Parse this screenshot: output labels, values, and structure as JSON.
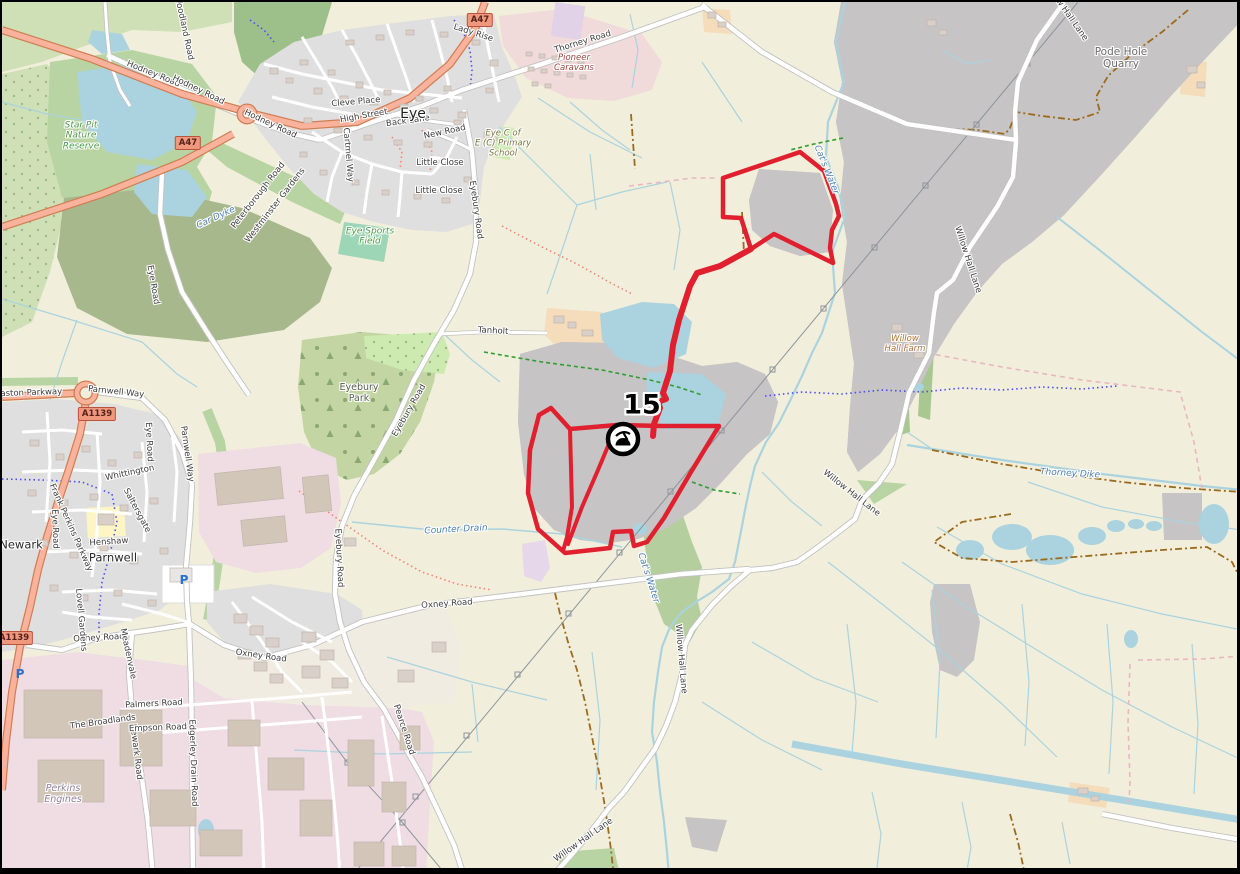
{
  "window": {
    "type": "map-viewer",
    "style": "openstreetmap-carto"
  },
  "map": {
    "marker": {
      "label": "15",
      "icon": "mine-pit-icon"
    },
    "colors": {
      "boundary_red": "#e0202e",
      "water": "#aad3df",
      "quarry": "#c6c4c4",
      "residential": "#e0dfdf",
      "industrial": "#f0dde3",
      "farmland": "#f1efdb",
      "grass": "#b8d4a2",
      "forest": "#9dbf89",
      "farmyard": "#f5dcba",
      "trunk_road": "#f9b29c",
      "road": "#ffffff",
      "track": "#9c6a1d",
      "cycleway": "#4b4bf7",
      "footpath": "#fa8072",
      "bridleway": "#2f9e2f"
    },
    "badges": [
      {
        "t": "A47",
        "x": 186,
        "y": 141
      },
      {
        "t": "A47",
        "x": 478,
        "y": 18
      },
      {
        "t": "A1139",
        "x": 95,
        "y": 412
      },
      {
        "t": "A1139",
        "x": 12,
        "y": 636
      }
    ],
    "parking": [
      {
        "x": 182,
        "y": 578
      },
      {
        "x": 18,
        "y": 672
      }
    ],
    "labels": [
      {
        "t": "Woodland Road",
        "x": 181,
        "y": 26,
        "r": 78,
        "c": "rd"
      },
      {
        "t": "Hodney Road",
        "x": 151,
        "y": 73,
        "r": 22,
        "c": "rd"
      },
      {
        "t": "Hodney Road",
        "x": 196,
        "y": 89,
        "r": 26,
        "c": "rd"
      },
      {
        "t": "Hodney Road",
        "x": 268,
        "y": 123,
        "r": 25,
        "c": "rd"
      },
      {
        "t": "High Street",
        "x": 362,
        "y": 115,
        "r": -10,
        "c": "rd"
      },
      {
        "t": "Back Lane",
        "x": 406,
        "y": 120,
        "r": -8,
        "c": "rd"
      },
      {
        "t": "New Road",
        "x": 443,
        "y": 131,
        "r": -12,
        "c": "rd"
      },
      {
        "t": "Little Close",
        "x": 438,
        "y": 162,
        "r": 0,
        "c": "rd"
      },
      {
        "t": "Little Close",
        "x": 437,
        "y": 190,
        "r": 0,
        "c": "rd"
      },
      {
        "t": "Lady Rise",
        "x": 471,
        "y": 32,
        "r": 18,
        "c": "rd"
      },
      {
        "t": "Cleve Place",
        "x": 354,
        "y": 101,
        "r": -5,
        "c": "rd"
      },
      {
        "t": "Cartmel Way",
        "x": 345,
        "y": 153,
        "r": 85,
        "c": "rd"
      },
      {
        "t": "Peterborough Road",
        "x": 257,
        "y": 194,
        "r": -52,
        "c": "rd"
      },
      {
        "t": "Westminster Gardens",
        "x": 274,
        "y": 204,
        "r": -52,
        "c": "rd"
      },
      {
        "t": "Thorney Road",
        "x": 581,
        "y": 41,
        "r": -17,
        "c": "rd"
      },
      {
        "t": "Eyebury Road",
        "x": 473,
        "y": 208,
        "r": 82,
        "c": "rd"
      },
      {
        "t": "Eyebury Road",
        "x": 408,
        "y": 409,
        "r": -60,
        "c": "rd"
      },
      {
        "t": "Eyebury Road",
        "x": 336,
        "y": 556,
        "r": 87,
        "c": "rd"
      },
      {
        "t": "Tanholt",
        "x": 491,
        "y": 330,
        "r": 3,
        "c": "rd"
      },
      {
        "t": "Pearce Road",
        "x": 401,
        "y": 728,
        "r": 72,
        "c": "rd"
      },
      {
        "t": "Oxney Road",
        "x": 97,
        "y": 637,
        "r": -3,
        "c": "rd"
      },
      {
        "t": "Oxney Road",
        "x": 259,
        "y": 655,
        "r": 8,
        "c": "rd"
      },
      {
        "t": "Oxney Road",
        "x": 445,
        "y": 603,
        "r": -4,
        "c": "rd"
      },
      {
        "t": "Willow Hall Lane",
        "x": 1063,
        "y": 10,
        "r": 55,
        "c": "rd"
      },
      {
        "t": "Willow Hall Lane",
        "x": 965,
        "y": 258,
        "r": 72,
        "c": "rd"
      },
      {
        "t": "Willow Hall Lane",
        "x": 849,
        "y": 492,
        "r": 38,
        "c": "rd"
      },
      {
        "t": "Willow Hall Lane",
        "x": 678,
        "y": 657,
        "r": 85,
        "c": "rd"
      },
      {
        "t": "Willow Hall Lane",
        "x": 582,
        "y": 839,
        "r": -35,
        "c": "rd"
      },
      {
        "t": "Edgerley Drain Road",
        "x": 190,
        "y": 761,
        "r": 88,
        "c": "rd"
      },
      {
        "t": "Newark Road",
        "x": 133,
        "y": 750,
        "r": 83,
        "c": "rd"
      },
      {
        "t": "Palmers Road",
        "x": 152,
        "y": 703,
        "r": -3,
        "c": "rd"
      },
      {
        "t": "Empson Road",
        "x": 156,
        "y": 727,
        "r": -2,
        "c": "rd"
      },
      {
        "t": "The Broadlands",
        "x": 101,
        "y": 721,
        "r": -8,
        "c": "rd"
      },
      {
        "t": "Whittington",
        "x": 128,
        "y": 472,
        "r": -12,
        "c": "rd"
      },
      {
        "t": "Saltersgate",
        "x": 134,
        "y": 509,
        "r": 62,
        "c": "rd"
      },
      {
        "t": "Henshaw",
        "x": 107,
        "y": 541,
        "r": -4,
        "c": "rd"
      },
      {
        "t": "Lovell Gardens",
        "x": 78,
        "y": 618,
        "r": 85,
        "c": "rd"
      },
      {
        "t": "Meadenvale",
        "x": 125,
        "y": 652,
        "r": 78,
        "c": "rd"
      },
      {
        "t": "Parnwell Way",
        "x": 114,
        "y": 391,
        "r": 6,
        "c": "rd"
      },
      {
        "t": "Parnwell Way",
        "x": 184,
        "y": 452,
        "r": 82,
        "c": "rd"
      },
      {
        "t": "Paston Parkway",
        "x": 27,
        "y": 392,
        "r": -2,
        "c": "rd"
      },
      {
        "t": "Frank Perkins Parkway",
        "x": 68,
        "y": 526,
        "r": 66,
        "c": "rd"
      },
      {
        "t": "Eye Road",
        "x": 150,
        "y": 283,
        "r": 80,
        "c": "rd"
      },
      {
        "t": "Eye Road",
        "x": 146,
        "y": 440,
        "r": 87,
        "c": "rd"
      },
      {
        "t": "Eye Road",
        "x": 52,
        "y": 527,
        "r": 88,
        "c": "rd"
      },
      {
        "t": "Eye",
        "x": 411,
        "y": 112,
        "r": 0,
        "c": "pl"
      },
      {
        "t": "Newark",
        "x": 19,
        "y": 543,
        "r": 0,
        "c": "pl2"
      },
      {
        "t": "Parnwell",
        "x": 111,
        "y": 556,
        "r": 0,
        "c": "pl2"
      },
      {
        "t": "Star Pit\nNature\nReserve",
        "x": 79,
        "y": 134,
        "r": 0,
        "c": "grn"
      },
      {
        "t": "Eyebury\nPark",
        "x": 357,
        "y": 392,
        "r": 0,
        "c": "park"
      },
      {
        "t": "Eye Sports\nField",
        "x": 368,
        "y": 235,
        "r": 0,
        "c": "grn"
      },
      {
        "t": "Pode Hole\nQuarry",
        "x": 1119,
        "y": 56,
        "r": 0,
        "c": "qry"
      },
      {
        "t": "Pioneer\nCaravans",
        "x": 572,
        "y": 62,
        "r": 0,
        "c": "tour"
      },
      {
        "t": "Eye C of\nE (C) Primary\nSchool",
        "x": 501,
        "y": 142,
        "r": 0,
        "c": "sch"
      },
      {
        "t": "Perkins\nEngines",
        "x": 61,
        "y": 793,
        "r": 0,
        "c": "ind"
      },
      {
        "t": "Willow\nHall Farm",
        "x": 903,
        "y": 343,
        "r": 0,
        "c": "farm"
      },
      {
        "t": "Counter Drain",
        "x": 454,
        "y": 528,
        "r": -3,
        "c": "wat"
      },
      {
        "t": "Car Dyke",
        "x": 214,
        "y": 216,
        "r": -25,
        "c": "wat"
      },
      {
        "t": "Cat's Water",
        "x": 824,
        "y": 168,
        "r": 68,
        "c": "wat"
      },
      {
        "t": "Cat's Water",
        "x": 646,
        "y": 576,
        "r": 72,
        "c": "wat"
      },
      {
        "t": "Thorney Dike",
        "x": 1068,
        "y": 472,
        "r": 3,
        "c": "wat"
      }
    ]
  }
}
